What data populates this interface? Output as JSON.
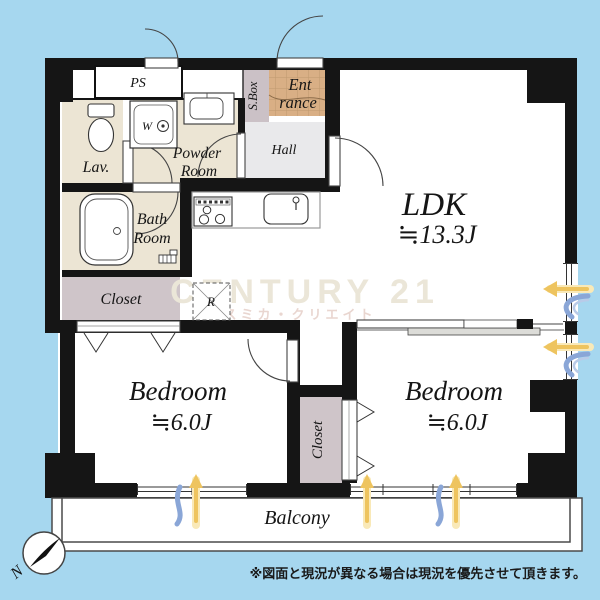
{
  "labels": {
    "ps": "PS",
    "sbox": "S.Box",
    "entrance1": "Ent",
    "entrance2": "rance",
    "hall": "Hall",
    "powder1": "Powder",
    "powder2": "Room",
    "lav": "Lav.",
    "bath1": "Bath",
    "bath2": "Room",
    "washer": "W",
    "fridge": "R",
    "closet_bedroom1": "Closet",
    "closet_bedroom2": "Closet",
    "ldk": "LDK",
    "ldk_size": "≒13.3J",
    "bedroom1": "Bedroom",
    "bedroom1_size": "≒6.0J",
    "bedroom2": "Bedroom",
    "bedroom2_size": "≒6.0J",
    "balcony": "Balcony",
    "north": "N"
  },
  "watermark": {
    "line1": "CENTURY 21",
    "line2": "スミカ・クリエイト"
  },
  "note": "※図面と現況が異なる場合は現況を優先させて頂きます。",
  "colors": {
    "background_blue": "#a6d7ef",
    "wall_black": "#151515",
    "wet_room_beige": "#ece5d4",
    "closet_mauve": "#cfc5c9",
    "entrance_tile_tan": "#d9af85",
    "hall_gray": "#e9e9eb",
    "sunlight_arrow_yellow": "#eec45f",
    "airflow_arrow_blue": "#8aa6d7",
    "watermark_cream": "#ebe6d8",
    "watermark_pink": "#e9d6d0"
  }
}
